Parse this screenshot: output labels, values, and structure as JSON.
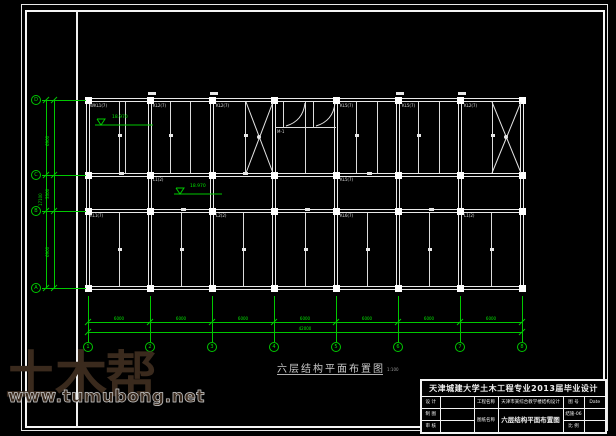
{
  "caption": {
    "title": "六层结构平面布置图",
    "scale": "1:100"
  },
  "watermark": {
    "logo": "土木帮",
    "url": "www.tumubong.net"
  },
  "title_block": {
    "header": "天津城建大学土木工程专业2013届毕业设计",
    "design_label": "设 计",
    "draft_label": "制 图",
    "check_label": "审 核",
    "project_label": "工程名称",
    "project_value": "天津市某综合教学楼结构设计",
    "drawing_label": "图纸名称",
    "drawing_value": "六层结构平面布置图",
    "no_label": "图 号",
    "no_value": "结施-06",
    "scale_label": "比 例",
    "date_label": "Date"
  },
  "plan": {
    "elevations": [
      "18.970",
      "18.970"
    ],
    "beam_labels": [
      "WKL1(7)",
      "KL2(7)",
      "KL2(7)",
      "KL5(7)",
      "KL5(7)",
      "KL2(7)",
      "L1(2)",
      "KL5(7)",
      "KL1(7)",
      "L2(2)",
      "KL6(7)",
      "L1(2)",
      "M-1"
    ],
    "axis_rows": [
      "D",
      "C",
      "B",
      "A"
    ],
    "axis_cols": [
      "1",
      "2",
      "3",
      "4",
      "5",
      "6",
      "7",
      "8"
    ]
  },
  "dims": {
    "left": [
      "6900",
      "3300",
      "6900"
    ],
    "left_total": "17100",
    "bottom_bays": [
      "6000",
      "6000",
      "6000",
      "6000",
      "6000",
      "6000",
      "6000"
    ],
    "bottom_total": "42000"
  },
  "colors": {
    "line_green": "#00c800",
    "beam_white": "#ffffff",
    "watermark_brown": "#3a2a1d"
  }
}
